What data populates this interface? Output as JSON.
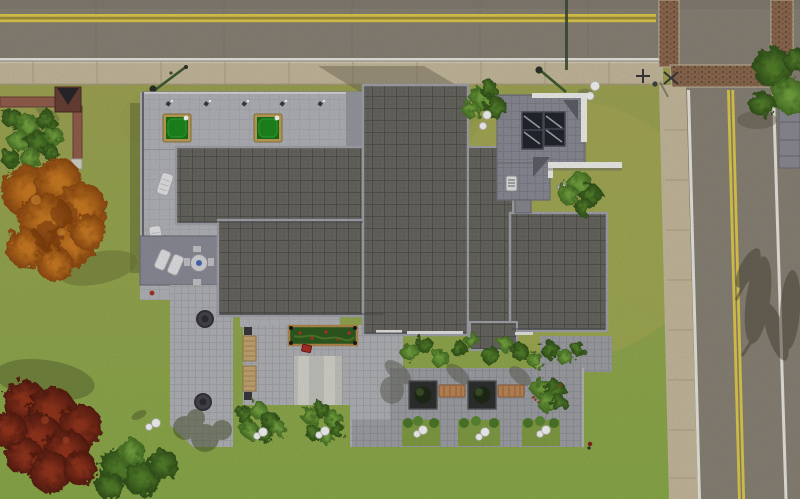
{
  "scene": {
    "type": "game-screenshot",
    "view": "top-down aerial build/buy view of a suburban lot",
    "description": "Modern house with dark square-tiled roofs and a light rooftop deck holding two green card tables and lounge chairs; paver patios and a sunken courtyard with tree planters, benches and globe lights; hedges and autumn trees; asphalt road with double yellow line along the top, a second road down the right side, brick crosswalk bands at their intersection; sidewalks with street lamps and signs."
  },
  "objects": {
    "card_tables": 2,
    "rooftop_wall_lamps": 5,
    "lounge_chairs": 4,
    "deck_dining_set": 1,
    "skylights": 2,
    "flower_planter_boxes": 1,
    "wooden_benches": 2,
    "courtyard_tree_planters": 2,
    "courtyard_metal_benches": 2,
    "globe_path_lights": 8,
    "hedge_clumps": 4,
    "autumn_trees": 2,
    "green_trees": 6,
    "street_lamps": 2,
    "street_sign_posts": 2,
    "crosswalk_brick_bands": 3,
    "dark_round_covers_on_path": 2
  },
  "colors": {
    "asphalt": "#8b8478",
    "asphaltDark": "#776f63",
    "roadYellow": "#e3ce4b",
    "roadYellowDark": "#a3923a",
    "roadWhite": "#eceae3",
    "sidewalk": "#c9bd9f",
    "sidewalkLine": "#b2a584",
    "grassTop": "#a3a756",
    "grassBottom": "#8cad4b",
    "grassShadow": "#5f6b33",
    "roofTile": "#6b6a64",
    "roofTileLine": "#53524c",
    "roofEdge": "#a4a5ae",
    "roofEdgeDark": "#44444a",
    "deckLight": "#b6b7bc",
    "deckDark": "#8d8e9a",
    "paverLight": "#b5b6ba",
    "paverMid": "#a2a3a8",
    "concretePad": "#c7c7c2",
    "concretePadLight": "#d9d9d2",
    "whiteWall": "#f3f3ef",
    "skylightGlass": "#23262e",
    "skyroofGray": "#8c8d97",
    "hedge": "#4e7a2b",
    "hedgeLight": "#699a39",
    "treeGreen": "#5d8c33",
    "treeDark": "#3c611f",
    "treeOrange": "#c1701e",
    "treeRed": "#8a2e1c",
    "brickWall": "#96604f",
    "crosswalkBrick": "#8f6b51",
    "tableFelt": "#187418",
    "tableFeltLight": "#2f9e2f",
    "tableFrame": "#c2a458",
    "benchWood": "#c9aa74",
    "copperBench": "#c08a5a",
    "planterGreen": "#2f5c20",
    "flowerRed": "#c23028",
    "globeWhite": "#fafafa",
    "metalDark": "#34343a",
    "lampGreen": "#3e5c30",
    "neighborGray": "#8e8d95"
  }
}
